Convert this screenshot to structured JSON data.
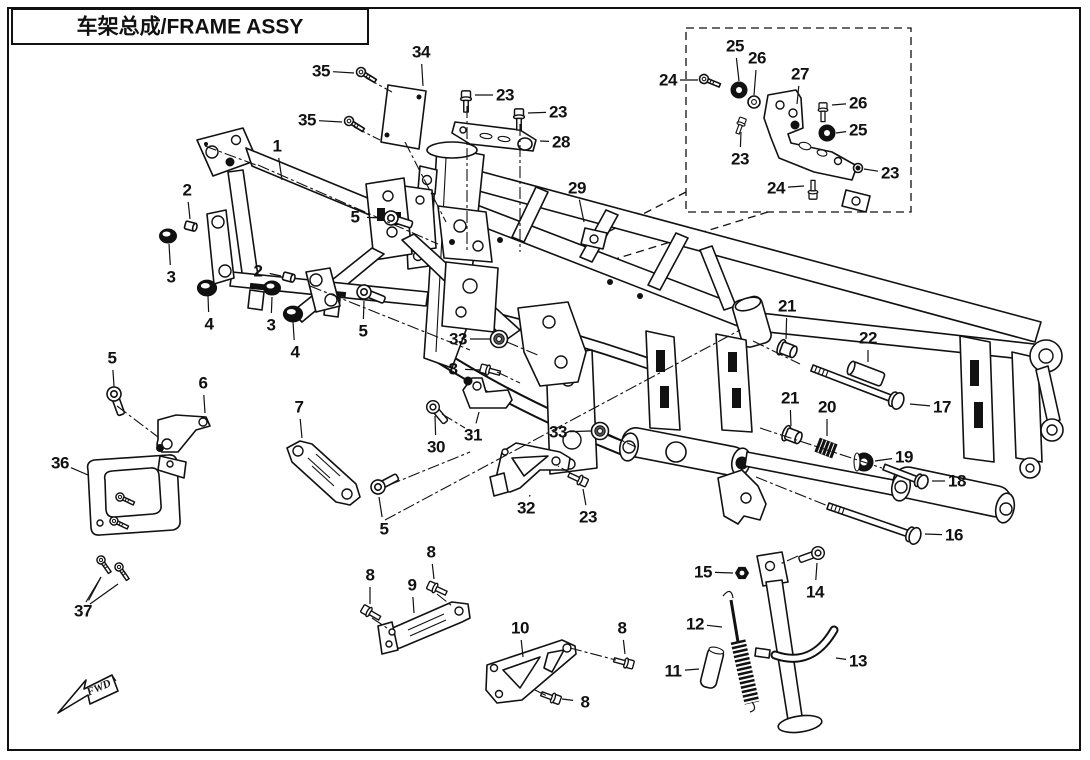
{
  "title": {
    "text": "车架总成/FRAME ASSY"
  },
  "fwd": {
    "label": "FWD"
  },
  "colors": {
    "line": "#111111",
    "paper": "#ffffff"
  },
  "callouts": [
    {
      "n": "35",
      "x": 321,
      "y": 71,
      "tx": 354,
      "ty": 73
    },
    {
      "n": "35",
      "x": 307,
      "y": 120,
      "tx": 342,
      "ty": 122
    },
    {
      "n": "34",
      "x": 421,
      "y": 52,
      "tx": 423,
      "ty": 86
    },
    {
      "n": "23",
      "x": 505,
      "y": 95,
      "tx": 475,
      "ty": 95
    },
    {
      "n": "23",
      "x": 558,
      "y": 112,
      "tx": 528,
      "ty": 113
    },
    {
      "n": "28",
      "x": 561,
      "y": 142,
      "tx": 540,
      "ty": 141
    },
    {
      "n": "29",
      "x": 577,
      "y": 188,
      "tx": 584,
      "ty": 222
    },
    {
      "n": "24",
      "x": 668,
      "y": 80,
      "tx": 698,
      "ty": 80
    },
    {
      "n": "25",
      "x": 735,
      "y": 46,
      "tx": 739,
      "ty": 81
    },
    {
      "n": "26",
      "x": 757,
      "y": 58,
      "tx": 754,
      "ty": 95
    },
    {
      "n": "27",
      "x": 800,
      "y": 74,
      "tx": 797,
      "ty": 104
    },
    {
      "n": "26",
      "x": 858,
      "y": 103,
      "tx": 832,
      "ty": 105
    },
    {
      "n": "25",
      "x": 858,
      "y": 130,
      "tx": 836,
      "ty": 133
    },
    {
      "n": "23",
      "x": 740,
      "y": 159,
      "tx": 741,
      "ty": 132
    },
    {
      "n": "23",
      "x": 890,
      "y": 173,
      "tx": 864,
      "ty": 169
    },
    {
      "n": "24",
      "x": 776,
      "y": 188,
      "tx": 804,
      "ty": 186
    },
    {
      "n": "1",
      "x": 277,
      "y": 146,
      "tx": 282,
      "ty": 180
    },
    {
      "n": "2",
      "x": 187,
      "y": 190,
      "tx": 190,
      "ty": 219
    },
    {
      "n": "3",
      "x": 171,
      "y": 277,
      "tx": 169,
      "ty": 244
    },
    {
      "n": "4",
      "x": 209,
      "y": 324,
      "tx": 208,
      "ty": 296
    },
    {
      "n": "2",
      "x": 258,
      "y": 271,
      "tx": 281,
      "ty": 276
    },
    {
      "n": "3",
      "x": 271,
      "y": 325,
      "tx": 272,
      "ty": 297
    },
    {
      "n": "4",
      "x": 295,
      "y": 352,
      "tx": 293,
      "ty": 322
    },
    {
      "n": "5",
      "x": 355,
      "y": 217,
      "tx": 383,
      "ty": 218
    },
    {
      "n": "5",
      "x": 363,
      "y": 331,
      "tx": 364,
      "ty": 301
    },
    {
      "n": "5",
      "x": 112,
      "y": 358,
      "tx": 114,
      "ty": 386
    },
    {
      "n": "6",
      "x": 203,
      "y": 383,
      "tx": 205,
      "ty": 413
    },
    {
      "n": "7",
      "x": 299,
      "y": 407,
      "tx": 302,
      "ty": 438
    },
    {
      "n": "36",
      "x": 60,
      "y": 463,
      "tx": 88,
      "ty": 475
    },
    {
      "n": "37",
      "x": 83,
      "y": 611,
      "tx": 101,
      "ty": 577
    },
    {
      "n": "33",
      "x": 458,
      "y": 339,
      "tx": 490,
      "ty": 339
    },
    {
      "n": "8",
      "x": 453,
      "y": 369,
      "tx": 480,
      "ty": 370
    },
    {
      "n": "30",
      "x": 436,
      "y": 447,
      "tx": 435,
      "ty": 416
    },
    {
      "n": "31",
      "x": 473,
      "y": 435,
      "tx": 479,
      "ty": 412
    },
    {
      "n": "33",
      "x": 558,
      "y": 432,
      "tx": 591,
      "ty": 431
    },
    {
      "n": "32",
      "x": 526,
      "y": 508,
      "tx": 530,
      "ty": 495
    },
    {
      "n": "23",
      "x": 588,
      "y": 517,
      "tx": 583,
      "ty": 489
    },
    {
      "n": "5",
      "x": 384,
      "y": 529,
      "tx": 379,
      "ty": 497
    },
    {
      "n": "8",
      "x": 370,
      "y": 575,
      "tx": 370,
      "ty": 604
    },
    {
      "n": "9",
      "x": 412,
      "y": 585,
      "tx": 414,
      "ty": 613
    },
    {
      "n": "8",
      "x": 431,
      "y": 552,
      "tx": 434,
      "ty": 579
    },
    {
      "n": "10",
      "x": 520,
      "y": 628,
      "tx": 523,
      "ty": 657
    },
    {
      "n": "8",
      "x": 622,
      "y": 628,
      "tx": 625,
      "ty": 654
    },
    {
      "n": "8",
      "x": 585,
      "y": 702,
      "tx": 562,
      "ty": 699
    },
    {
      "n": "11",
      "x": 673,
      "y": 671,
      "tx": 699,
      "ty": 669
    },
    {
      "n": "12",
      "x": 695,
      "y": 624,
      "tx": 722,
      "ty": 627
    },
    {
      "n": "13",
      "x": 858,
      "y": 661,
      "tx": 836,
      "ty": 658
    },
    {
      "n": "14",
      "x": 815,
      "y": 592,
      "tx": 817,
      "ty": 563
    },
    {
      "n": "15",
      "x": 703,
      "y": 572,
      "tx": 733,
      "ty": 573
    },
    {
      "n": "16",
      "x": 954,
      "y": 535,
      "tx": 925,
      "ty": 534
    },
    {
      "n": "17",
      "x": 942,
      "y": 407,
      "tx": 910,
      "ty": 404
    },
    {
      "n": "18",
      "x": 957,
      "y": 481,
      "tx": 932,
      "ty": 481
    },
    {
      "n": "19",
      "x": 904,
      "y": 457,
      "tx": 875,
      "ty": 461
    },
    {
      "n": "20",
      "x": 827,
      "y": 407,
      "tx": 827,
      "ty": 436
    },
    {
      "n": "21",
      "x": 787,
      "y": 306,
      "tx": 786,
      "ty": 339
    },
    {
      "n": "21",
      "x": 790,
      "y": 398,
      "tx": 791,
      "ty": 426
    },
    {
      "n": "22",
      "x": 868,
      "y": 338,
      "tx": 868,
      "ty": 362
    }
  ]
}
